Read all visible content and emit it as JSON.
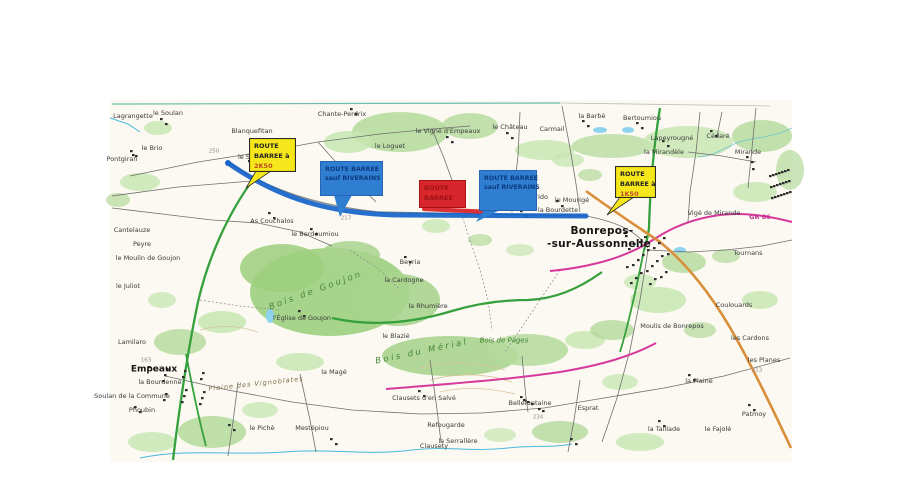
{
  "document": {
    "type": "scanned road-closure map",
    "town_main": "Bonrepos-sur-Aussonnelle",
    "town_secondary": "Empeaux"
  },
  "annotations": {
    "colors": {
      "sign_yellow": "#f6e71d",
      "sign_blue": "#2f7ed2",
      "sign_red": "#d8262c",
      "route_overlay_blue": "#1563c9",
      "closed_segment_red": "#d8262c"
    },
    "yellow_left": {
      "lines": [
        "ROUTE",
        "BARREE à",
        "2K50"
      ]
    },
    "blue_left": {
      "lines": [
        "ROUTE BARREE",
        "sauf RIVERAINS"
      ]
    },
    "red_panel": {
      "lines": [
        "ROUTE",
        "BARREE"
      ]
    },
    "blue_right": {
      "lines": [
        "ROUTE BARREE",
        "sauf RIVERAINS"
      ]
    },
    "yellow_right": {
      "lines": [
        "ROUTE",
        "BARREE à",
        "1K50"
      ]
    }
  },
  "map": {
    "labels": [
      {
        "text": "Lagrangette",
        "x": 133,
        "y": 116
      },
      {
        "text": "le Soulan",
        "x": 168,
        "y": 113
      },
      {
        "text": "le Brio",
        "x": 152,
        "y": 148
      },
      {
        "text": "Pontgiran",
        "x": 122,
        "y": 159
      },
      {
        "text": "Blanquefitan",
        "x": 252,
        "y": 131
      },
      {
        "text": "le Soulan",
        "x": 253,
        "y": 157
      },
      {
        "text": "la Boudère",
        "x": 266,
        "y": 169
      },
      {
        "text": "Maison Neuve",
        "x": 354,
        "y": 172
      },
      {
        "text": "la Cabène",
        "x": 341,
        "y": 184
      },
      {
        "text": "Chante-Perdrix",
        "x": 342,
        "y": 114
      },
      {
        "text": "le Loguet",
        "x": 390,
        "y": 146
      },
      {
        "text": "le Vigné d'Empeaux",
        "x": 448,
        "y": 131
      },
      {
        "text": "le Château",
        "x": 510,
        "y": 127
      },
      {
        "text": "Carmail",
        "x": 552,
        "y": 129
      },
      {
        "text": "la Barbè",
        "x": 592,
        "y": 116
      },
      {
        "text": "Bertoumiou",
        "x": 642,
        "y": 118
      },
      {
        "text": "Lapeyrougné",
        "x": 672,
        "y": 138
      },
      {
        "text": "la Mirandèle",
        "x": 664,
        "y": 152
      },
      {
        "text": "Cédaré",
        "x": 718,
        "y": 136
      },
      {
        "text": "Mirande",
        "x": 748,
        "y": 152
      },
      {
        "text": "Vigé de Mirande",
        "x": 714,
        "y": 213
      },
      {
        "text": "GR 86",
        "x": 760,
        "y": 217,
        "cls": "pink"
      },
      {
        "text": "As Couchalos",
        "x": 272,
        "y": 221
      },
      {
        "text": "le Berdoumiou",
        "x": 315,
        "y": 234
      },
      {
        "text": "le Mourigé",
        "x": 572,
        "y": 200
      },
      {
        "text": "le Nourrido",
        "x": 530,
        "y": 197
      },
      {
        "text": "la Mouréto",
        "x": 520,
        "y": 206
      },
      {
        "text": "la Bourdette",
        "x": 558,
        "y": 210
      },
      {
        "text": "Beyria",
        "x": 410,
        "y": 262
      },
      {
        "text": "la Cardogne",
        "x": 404,
        "y": 280
      },
      {
        "text": "la Rhumière",
        "x": 428,
        "y": 306
      },
      {
        "text": "Bois de Goujon",
        "x": 316,
        "y": 291,
        "cls": "woodbig",
        "rot": -20
      },
      {
        "text": "l'Église de Goujon",
        "x": 302,
        "y": 318
      },
      {
        "text": "Bonrepos-",
        "x": 602,
        "y": 231,
        "cls": "town"
      },
      {
        "text": "-sur-Aussonnelle",
        "x": 599,
        "y": 244,
        "cls": "town"
      },
      {
        "text": "Tournans",
        "x": 748,
        "y": 253
      },
      {
        "text": "Coulouards",
        "x": 734,
        "y": 305
      },
      {
        "text": "les Cardons",
        "x": 750,
        "y": 338
      },
      {
        "text": "Moulis de Bonrepos",
        "x": 672,
        "y": 326
      },
      {
        "text": "Empeaux",
        "x": 154,
        "y": 370,
        "cls": "town2"
      },
      {
        "text": "la Bourdenne",
        "x": 160,
        "y": 382
      },
      {
        "text": "Soulan de la Commune",
        "x": 132,
        "y": 396
      },
      {
        "text": "Phoubin",
        "x": 142,
        "y": 410
      },
      {
        "text": "Cantelauze",
        "x": 132,
        "y": 230
      },
      {
        "text": "Peyre",
        "x": 142,
        "y": 244
      },
      {
        "text": "le Moulin de Goujon",
        "x": 148,
        "y": 258
      },
      {
        "text": "le Juliot",
        "x": 128,
        "y": 286
      },
      {
        "text": "Lamilaro",
        "x": 132,
        "y": 342
      },
      {
        "text": "Bois du Mérial",
        "x": 422,
        "y": 352,
        "cls": "woodbig",
        "rot": -12
      },
      {
        "text": "Bois de Pages",
        "x": 504,
        "y": 341,
        "cls": "wood"
      },
      {
        "text": "Plaine des Vignoblates",
        "x": 256,
        "y": 384,
        "cls": "plain",
        "rot": -6
      },
      {
        "text": "le Blazié",
        "x": 396,
        "y": 336
      },
      {
        "text": "la Magé",
        "x": 334,
        "y": 372
      },
      {
        "text": "Clausets d'en Salvé",
        "x": 424,
        "y": 398
      },
      {
        "text": "Bellefontaine",
        "x": 530,
        "y": 403
      },
      {
        "text": "Esprat",
        "x": 588,
        "y": 408
      },
      {
        "text": "Refougarde",
        "x": 446,
        "y": 425
      },
      {
        "text": "la Serrallère",
        "x": 458,
        "y": 441
      },
      {
        "text": "Mestépiou",
        "x": 312,
        "y": 428
      },
      {
        "text": "le Pichè",
        "x": 262,
        "y": 428
      },
      {
        "text": "Clausety",
        "x": 434,
        "y": 446
      },
      {
        "text": "les Planes",
        "x": 764,
        "y": 360
      },
      {
        "text": "la Plaine",
        "x": 699,
        "y": 381
      },
      {
        "text": "Patmoy",
        "x": 754,
        "y": 414
      },
      {
        "text": "la Taillade",
        "x": 664,
        "y": 429
      },
      {
        "text": "le Fajolé",
        "x": 718,
        "y": 429
      },
      {
        "text": "250",
        "x": 214,
        "y": 152,
        "cls": "elev"
      },
      {
        "text": "217",
        "x": 346,
        "y": 219,
        "cls": "elev"
      },
      {
        "text": "234",
        "x": 538,
        "y": 418,
        "cls": "elev"
      },
      {
        "text": "213",
        "x": 757,
        "y": 371,
        "cls": "elev"
      },
      {
        "text": "163",
        "x": 146,
        "y": 361,
        "cls": "elev"
      }
    ],
    "building_clusters": [
      {
        "x": 624,
        "y": 232,
        "w": 44,
        "h": 52,
        "n": 26
      },
      {
        "x": 148,
        "y": 366,
        "w": 56,
        "h": 44,
        "n": 16
      },
      {
        "x": 752,
        "y": 168,
        "w": 38,
        "h": 34,
        "n": 22
      },
      {
        "x": 248,
        "y": 160,
        "w": 20,
        "h": 14,
        "n": 5
      },
      {
        "x": 352,
        "y": 176,
        "w": 14,
        "h": 8,
        "n": 3
      },
      {
        "x": 520,
        "y": 396,
        "w": 26,
        "h": 16,
        "n": 6
      },
      {
        "x": 268,
        "y": 212,
        "w": 8,
        "h": 6,
        "n": 2
      },
      {
        "x": 310,
        "y": 228,
        "w": 8,
        "h": 6,
        "n": 2
      },
      {
        "x": 404,
        "y": 256,
        "w": 8,
        "h": 6,
        "n": 2
      },
      {
        "x": 298,
        "y": 310,
        "w": 8,
        "h": 6,
        "n": 2
      },
      {
        "x": 556,
        "y": 200,
        "w": 8,
        "h": 6,
        "n": 2
      },
      {
        "x": 688,
        "y": 374,
        "w": 8,
        "h": 6,
        "n": 2
      },
      {
        "x": 658,
        "y": 420,
        "w": 8,
        "h": 6,
        "n": 2
      },
      {
        "x": 748,
        "y": 404,
        "w": 8,
        "h": 6,
        "n": 2
      },
      {
        "x": 418,
        "y": 390,
        "w": 8,
        "h": 6,
        "n": 2
      },
      {
        "x": 228,
        "y": 424,
        "w": 8,
        "h": 6,
        "n": 2
      },
      {
        "x": 330,
        "y": 438,
        "w": 8,
        "h": 6,
        "n": 2
      },
      {
        "x": 570,
        "y": 438,
        "w": 8,
        "h": 6,
        "n": 2
      },
      {
        "x": 134,
        "y": 406,
        "w": 8,
        "h": 6,
        "n": 2
      },
      {
        "x": 710,
        "y": 130,
        "w": 8,
        "h": 6,
        "n": 2
      },
      {
        "x": 662,
        "y": 140,
        "w": 8,
        "h": 6,
        "n": 2
      },
      {
        "x": 746,
        "y": 156,
        "w": 8,
        "h": 6,
        "n": 2
      },
      {
        "x": 350,
        "y": 108,
        "w": 8,
        "h": 6,
        "n": 2
      },
      {
        "x": 446,
        "y": 136,
        "w": 8,
        "h": 6,
        "n": 2
      },
      {
        "x": 506,
        "y": 132,
        "w": 8,
        "h": 6,
        "n": 2
      },
      {
        "x": 582,
        "y": 120,
        "w": 8,
        "h": 6,
        "n": 2
      },
      {
        "x": 636,
        "y": 122,
        "w": 8,
        "h": 6,
        "n": 2
      },
      {
        "x": 520,
        "y": 210,
        "w": 8,
        "h": 6,
        "n": 2
      },
      {
        "x": 130,
        "y": 150,
        "w": 8,
        "h": 6,
        "n": 3
      },
      {
        "x": 160,
        "y": 118,
        "w": 8,
        "h": 6,
        "n": 2
      }
    ]
  }
}
